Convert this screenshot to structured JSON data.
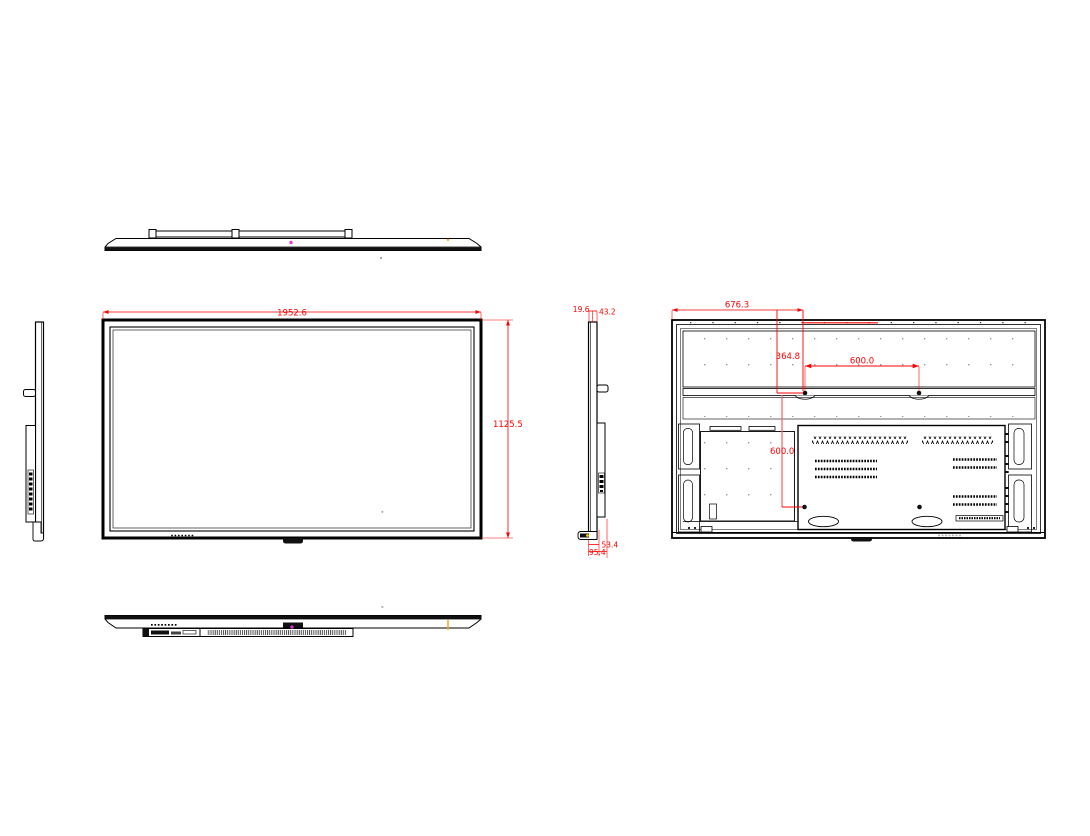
{
  "dimensions": {
    "front": {
      "width": "1952.6",
      "height": "1125.5"
    },
    "side_top": {
      "panel_thickness": "19.6",
      "depth_at_top": "43.2"
    },
    "side_bottom": {
      "depth_mid": "53.4",
      "depth_total": "95.4"
    },
    "rear": {
      "mount_from_left": "676.3",
      "mount_from_top": "364.8",
      "vesa_width": "600.0",
      "vesa_height": "600.0"
    }
  },
  "colors": {
    "background": "#ffffff",
    "line": "#000000",
    "dimension": "#ff0000",
    "dimension_light": "#ff6666",
    "accent_magenta": "#e22ee2",
    "accent_orange": "#f5a623",
    "accent_yellow": "#ffd400"
  }
}
